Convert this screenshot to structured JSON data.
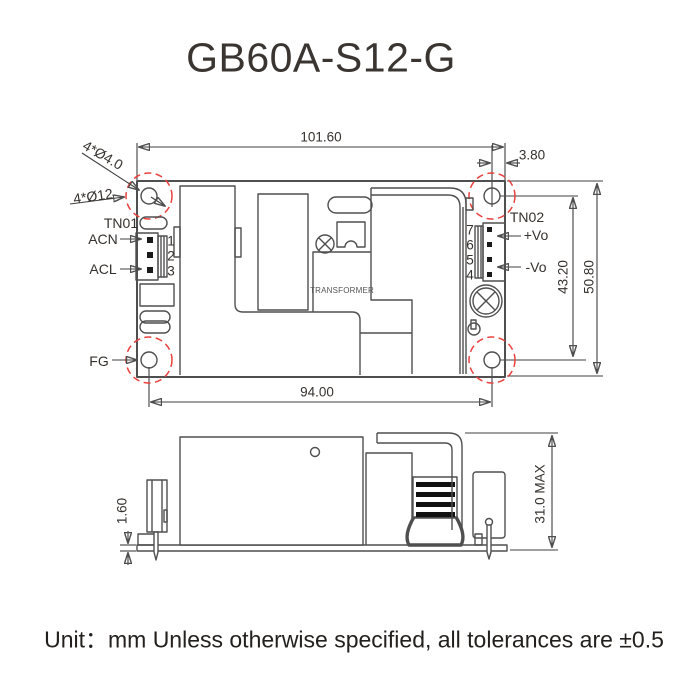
{
  "title": "GB60A-S12-G",
  "footer_note": "Unit：mm Unless otherwise specified, all tolerances are ±0.5",
  "colors": {
    "line": "#4f4f4f",
    "dimension_line": "#3f3f3f",
    "text": "#35312e",
    "hole_highlight_red": "#e8423e"
  },
  "top_view": {
    "dimensions": {
      "overall_width": "101.60",
      "hole_to_edge": "3.80",
      "hole_pitch_horizontal": "94.00",
      "hole_pitch_vertical": "43.20",
      "overall_depth": "50.80"
    },
    "hole_labels": {
      "drill": "4*Ø4.0",
      "clearance": "4*Ø12"
    },
    "tn01": {
      "label": "TN01",
      "pins": [
        "1",
        "2",
        "3"
      ],
      "acn": "ACN",
      "acl": "ACL"
    },
    "tn02": {
      "label": "TN02",
      "pins": [
        "7",
        "6",
        "5",
        "4"
      ],
      "vo_plus": "+Vo",
      "vo_minus": "-Vo"
    },
    "fg": "FG",
    "transformer": "TRANSFORMER"
  },
  "side_view": {
    "dimensions": {
      "pcb_thickness": "1.60",
      "component_max_height": "31.0 MAX"
    }
  }
}
